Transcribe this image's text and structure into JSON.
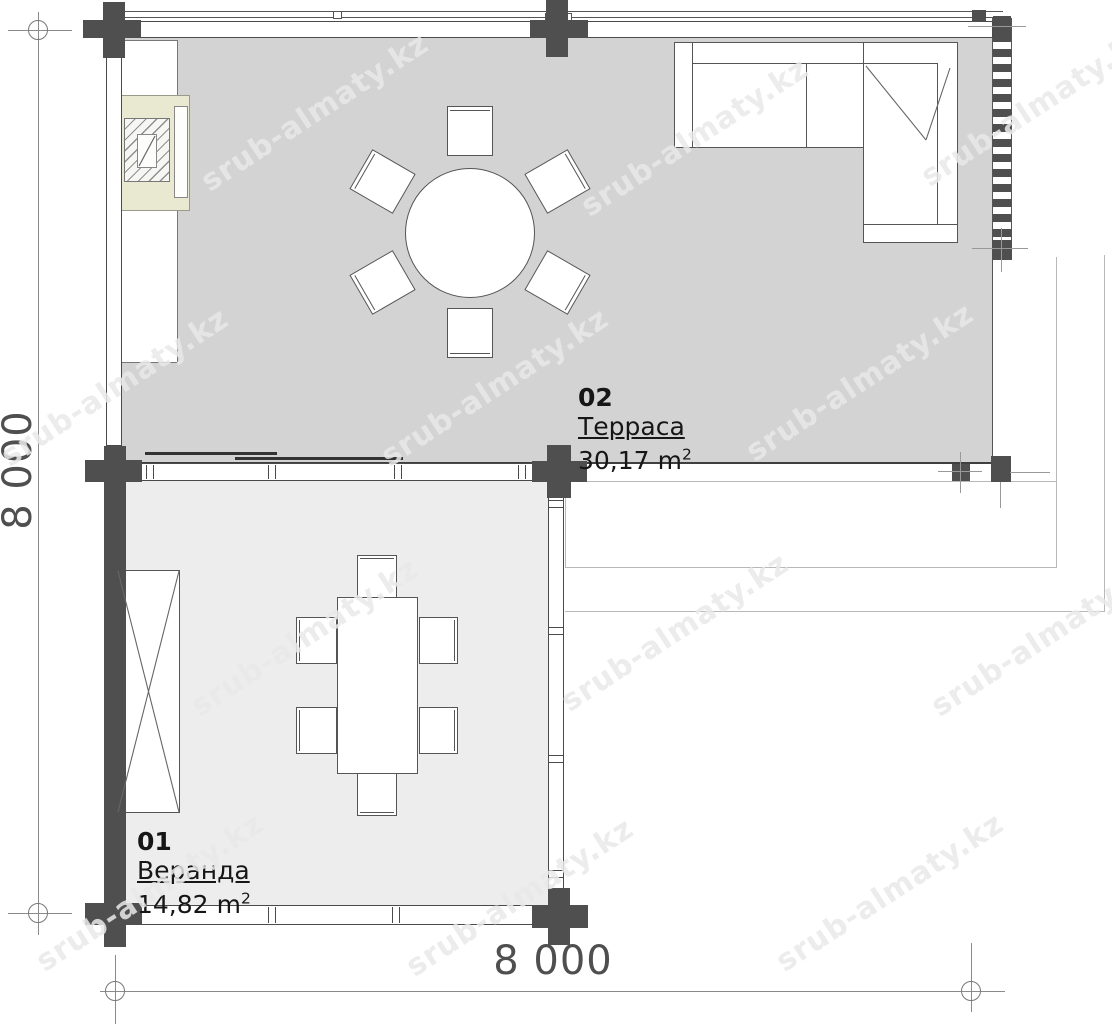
{
  "watermark": "srub-almaty.kz",
  "dimensions": {
    "left": "8 000",
    "bottom": "8 000"
  },
  "rooms": {
    "terrace": {
      "number": "02",
      "name": "Терраса",
      "area": "30,17",
      "unit": "m",
      "unit_sup": "2"
    },
    "veranda": {
      "number": "01",
      "name": "Веранда",
      "area": "14,82",
      "unit": "m",
      "unit_sup": "2"
    }
  },
  "colors": {
    "terrace_floor": "#d3d3d3",
    "veranda_floor": "#ededed",
    "post": "#4f4f4f",
    "fireplace": "#e9e8d0",
    "dimension_text": "#4f4f4f"
  }
}
